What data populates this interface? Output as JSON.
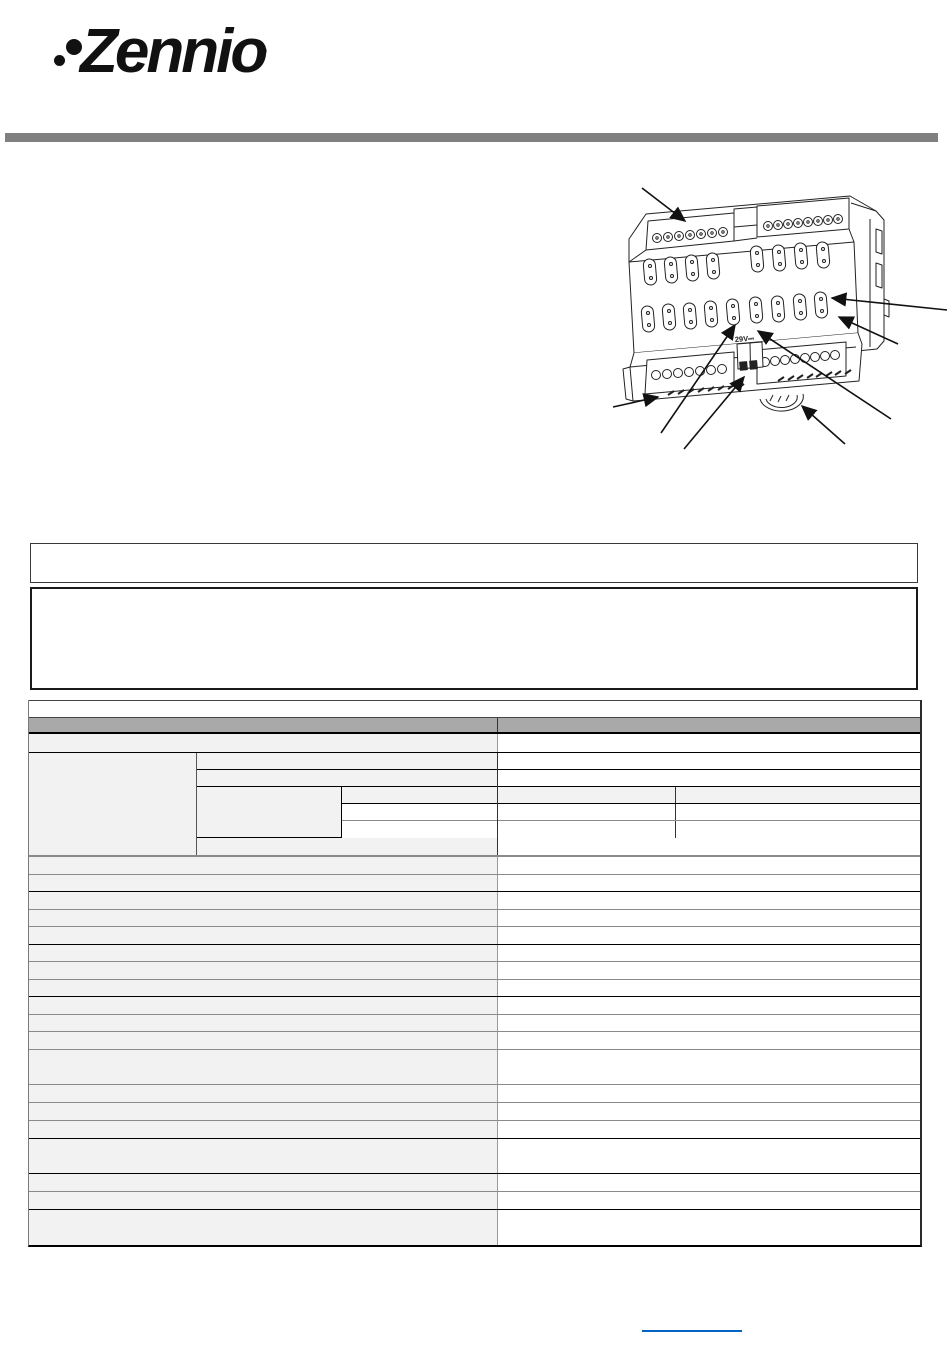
{
  "brand": {
    "logo_text": "Zennio",
    "registered_mark": "®"
  },
  "device_drawing": {
    "voltage_label": "29V⎓"
  },
  "colors": {
    "logo": "#111111",
    "divider_bar": "#808080",
    "drawing_stroke": "#222222",
    "arrow": "#111111",
    "box_border": "#1a1a1a",
    "table_header_bg": "#a9a9a9",
    "table_cell_bg": "#f2f2f2",
    "table_border_dark": "#000000",
    "table_border_gray": "#8a8a8a",
    "table_border_light": "#999999",
    "footer_link": "#0563c1"
  },
  "table": {
    "left_col_width": 469,
    "nested": {
      "outer_left_width": 168,
      "mid_width": 301,
      "mid_inner_left_width": 145,
      "right_split_offset": 178,
      "row_heights": [
        17,
        17,
        51,
        17
      ]
    },
    "rows": [
      {
        "t": "title",
        "h": 18
      },
      {
        "t": "header",
        "h": 16
      },
      {
        "t": "split",
        "h": 19,
        "bb": "dark"
      },
      {
        "t": "nested",
        "h": 104
      },
      {
        "t": "split",
        "h": 18,
        "bb": "gray"
      },
      {
        "t": "split",
        "h": 17,
        "bb": "dark"
      },
      {
        "t": "split",
        "h": 18,
        "bb": "gray"
      },
      {
        "t": "split",
        "h": 17,
        "bb": "gray"
      },
      {
        "t": "split",
        "h": 18,
        "bb": "dark"
      },
      {
        "t": "split",
        "h": 17,
        "bb": "gray"
      },
      {
        "t": "split",
        "h": 18,
        "bb": "gray"
      },
      {
        "t": "split",
        "h": 17,
        "bb": "dark"
      },
      {
        "t": "split",
        "h": 18,
        "bb": "gray"
      },
      {
        "t": "split",
        "h": 17,
        "bb": "gray"
      },
      {
        "t": "split",
        "h": 18,
        "bb": "gray"
      },
      {
        "t": "split",
        "h": 35,
        "bb": "gray"
      },
      {
        "t": "split",
        "h": 18,
        "bb": "gray"
      },
      {
        "t": "split",
        "h": 18,
        "bb": "gray"
      },
      {
        "t": "split",
        "h": 18,
        "bb": "dark"
      },
      {
        "t": "split",
        "h": 35,
        "bb": "dark"
      },
      {
        "t": "split",
        "h": 18,
        "bb": "gray"
      },
      {
        "t": "split",
        "h": 18,
        "bb": "dark"
      },
      {
        "t": "split",
        "h": 35,
        "bb": "none"
      }
    ]
  }
}
